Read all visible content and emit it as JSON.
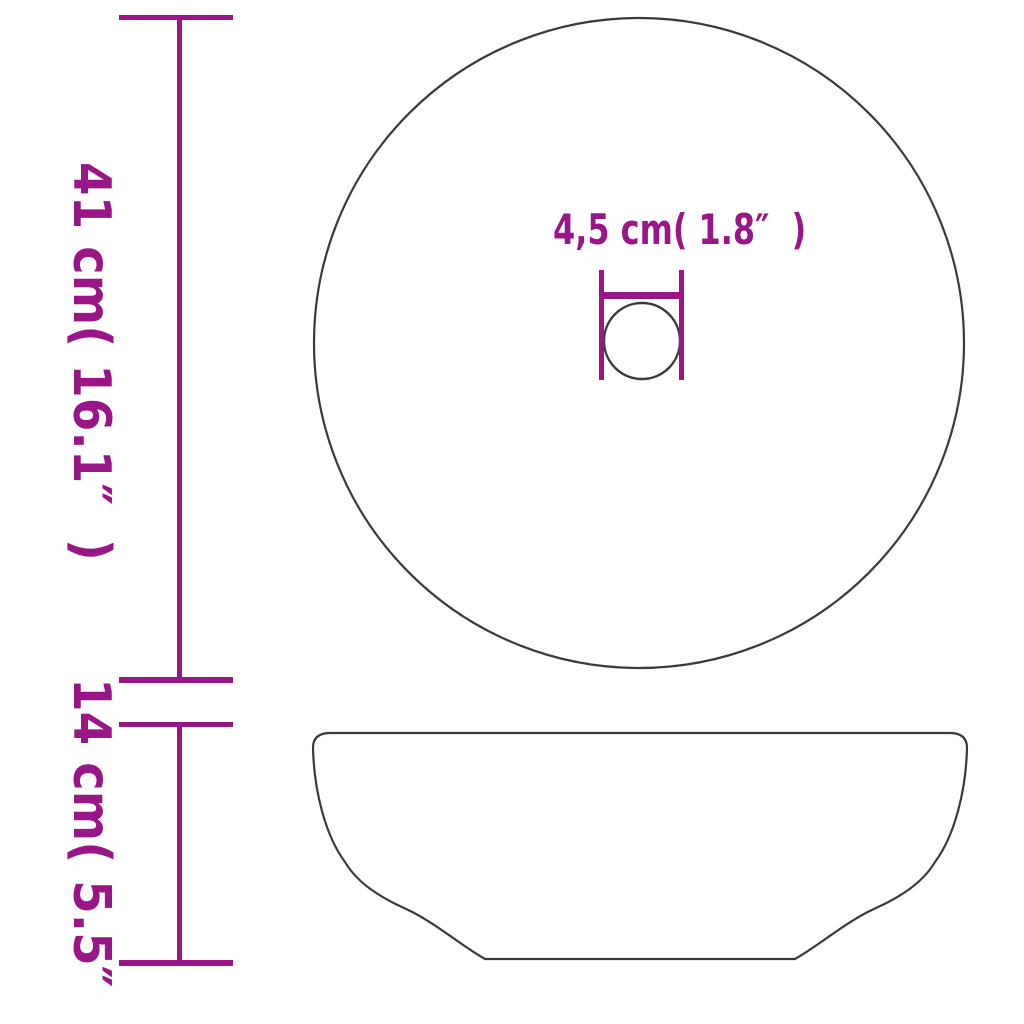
{
  "colors": {
    "dimension-accent": "#991686",
    "outline": "#3a3a3a",
    "background": "#ffffff"
  },
  "labels": {
    "total_diameter": "41 cm( 16.1″  )",
    "basin_height": "14 cm( 5.5″   )",
    "drain_diameter": "4,5 cm( 1.8″  )"
  },
  "measurements": {
    "total_diameter": {
      "cm": "41",
      "inch": "16.1"
    },
    "basin_height": {
      "cm": "14",
      "inch": "5.5"
    },
    "drain_diameter": {
      "cm": "4,5",
      "inch": "1.8"
    }
  }
}
